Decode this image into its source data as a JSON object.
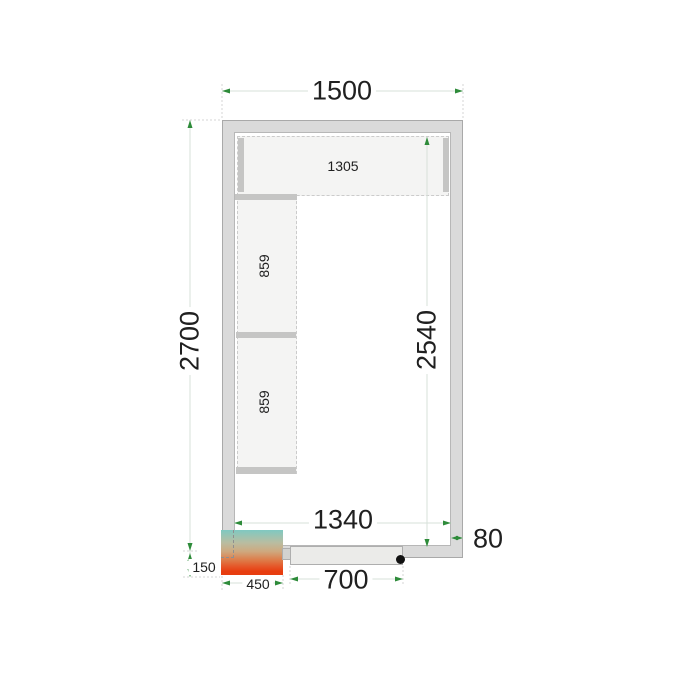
{
  "diagram": {
    "type": "cold-room-floor-plan",
    "labels": {
      "outer_width": "1500",
      "outer_depth": "2700",
      "inner_depth": "2540",
      "inner_width": "1340",
      "door_width": "700",
      "wall_thickness": "80",
      "unit_width": "450",
      "unit_offset": "150",
      "top_shelf_length": "1305",
      "left_shelf_upper": "859",
      "left_shelf_lower": "859"
    },
    "colors": {
      "wall_fill": "#dadada",
      "wall_border": "#a9a9a9",
      "shelf_fill": "#f4f4f3",
      "shelf_border": "#cbcbcb",
      "shelf_support": "#c5c5c4",
      "dim_line": "#d7e0da",
      "ext_line": "#d6d6d6",
      "arrow": "#2e8b3a",
      "text": "#202020",
      "door_fill": "#ebebe9",
      "handle_dot": "#111111",
      "unit_gradient_css": "linear-gradient(180deg,#7fc9c1 0%,#b9bda1 28%,#cfa87e 48%,#dd7e4b 66%,#e65426 82%,#e73d10 92%)"
    }
  }
}
